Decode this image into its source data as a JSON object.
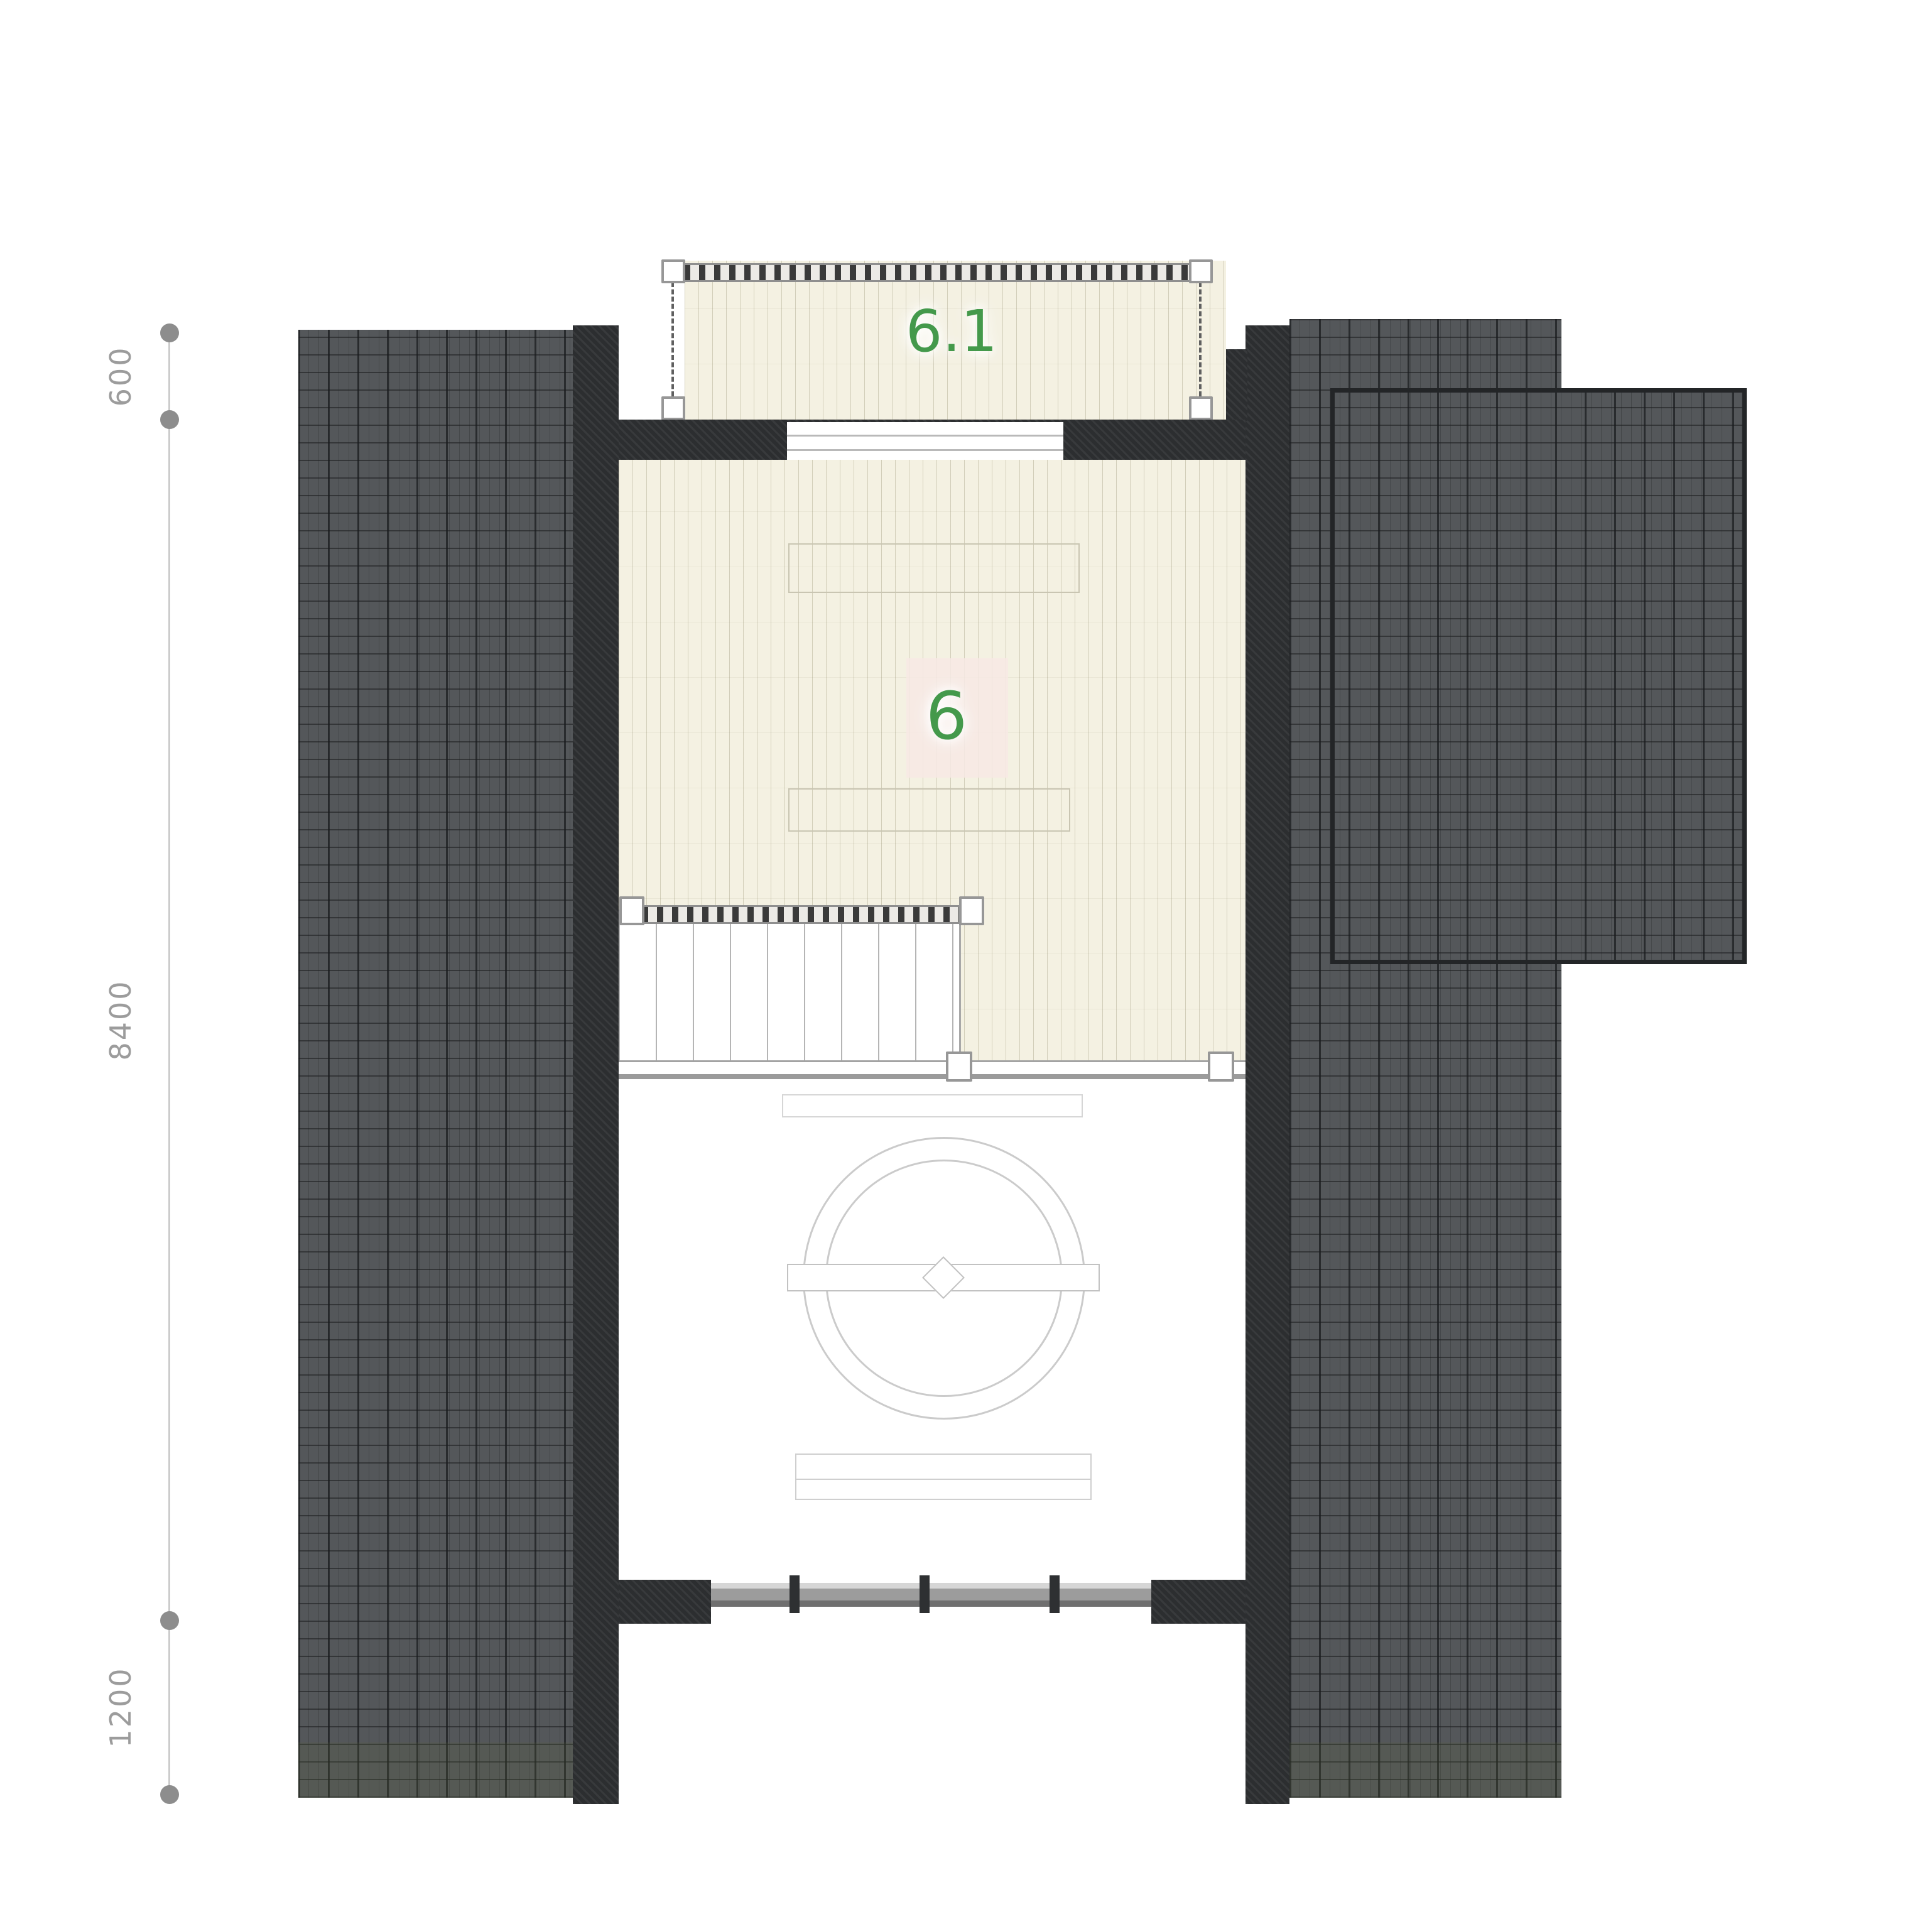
{
  "drawing": {
    "type": "architectural-floor-plan",
    "level": "attic",
    "room_main": {
      "label": "6"
    },
    "room_balcony": {
      "label": "6.1"
    },
    "dimensions": {
      "top": "600",
      "middle": "8400",
      "bottom": "1200"
    },
    "colors": {
      "accent_green": "#44994b",
      "roof_gray": "#54575a",
      "wall_dark": "#2c2e30",
      "wood_floor": "#f4f1e2",
      "dimension_gray": "#9c9c9c",
      "background": "#ffffff"
    },
    "symbols": [
      "roof-tile-hatch",
      "wood-plank-floor",
      "stair-run",
      "guard-railing",
      "ceiling-fan-symbol",
      "dimension-chain"
    ]
  }
}
